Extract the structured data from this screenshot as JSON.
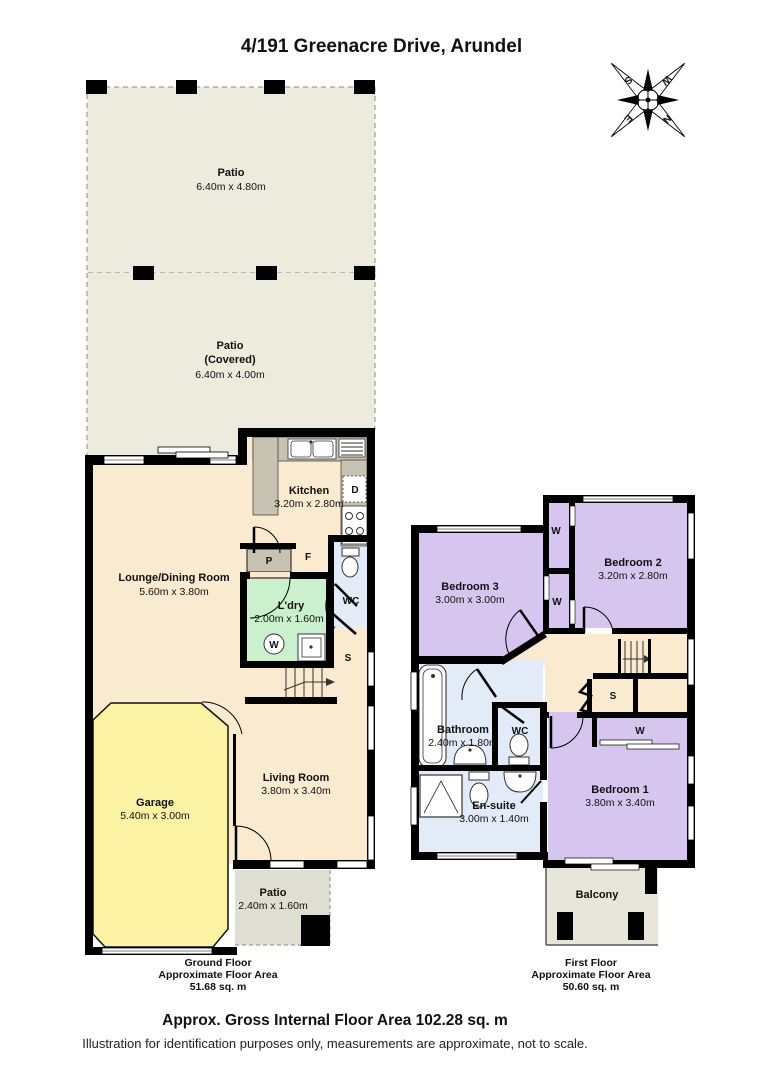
{
  "page": {
    "title": "4/191 Greenacre Drive, Arundel",
    "gross_area": "Approx. Gross Internal Floor Area 102.28 sq. m",
    "disclaimer": "Illustration for identification purposes only, measurements are approximate, not to scale."
  },
  "compass": {
    "north": "N",
    "east": "E",
    "south": "S",
    "west": "W"
  },
  "ground_floor": {
    "area_label": {
      "line1": "Ground Floor",
      "line2": "Approximate Floor Area",
      "line3": "51.68 sq. m"
    },
    "rooms": {
      "patio_rear": {
        "name": "Patio",
        "dims": "6.40m x 4.80m"
      },
      "patio_covered": {
        "name": "Patio",
        "qualifier": "(Covered)",
        "dims": "6.40m x 4.00m"
      },
      "kitchen": {
        "name": "Kitchen",
        "dims": "3.20m x 2.80m"
      },
      "lounge_dining": {
        "name": "Lounge/Dining Room",
        "dims": "5.60m x 3.80m"
      },
      "laundry": {
        "name": "L'dry",
        "dims": "2.00m x 1.60m"
      },
      "wc": {
        "name": "WC"
      },
      "living": {
        "name": "Living Room",
        "dims": "3.80m x 3.40m"
      },
      "garage": {
        "name": "Garage",
        "dims": "5.40m x 3.00m"
      },
      "patio_front": {
        "name": "Patio",
        "dims": "2.40m x 1.60m"
      }
    },
    "markers": {
      "pantry": "P",
      "fridge": "F",
      "washer": "W",
      "storage": "S",
      "dishwasher": "D"
    }
  },
  "first_floor": {
    "area_label": {
      "line1": "First Floor",
      "line2": "Approximate Floor Area",
      "line3": "50.60 sq. m"
    },
    "rooms": {
      "bedroom1": {
        "name": "Bedroom 1",
        "dims": "3.80m x 3.40m"
      },
      "bedroom2": {
        "name": "Bedroom 2",
        "dims": "3.20m x 2.80m"
      },
      "bedroom3": {
        "name": "Bedroom 3",
        "dims": "3.00m x 3.00m"
      },
      "bathroom": {
        "name": "Bathroom",
        "dims": "2.40m x 1.80m"
      },
      "wc": {
        "name": "WC"
      },
      "ensuite": {
        "name": "En-suite",
        "dims": "3.00m x 1.40m"
      },
      "balcony": {
        "name": "Balcony"
      }
    },
    "markers": {
      "wardrobe": "W",
      "storage": "S"
    }
  },
  "colors": {
    "wall": "#000000",
    "interior_floor": "#FAEACF",
    "patio": "#ECEBDE",
    "patio_small": "#DFDED2",
    "balcony": "#E8E6DA",
    "counter_gray": "#C8C2B2",
    "laundry_green": "#CBF0CE",
    "wet_area_blue": "#E4EBF8",
    "garage_yellow": "#FBF2A3",
    "bedroom_purple": "#D6C6EF"
  }
}
